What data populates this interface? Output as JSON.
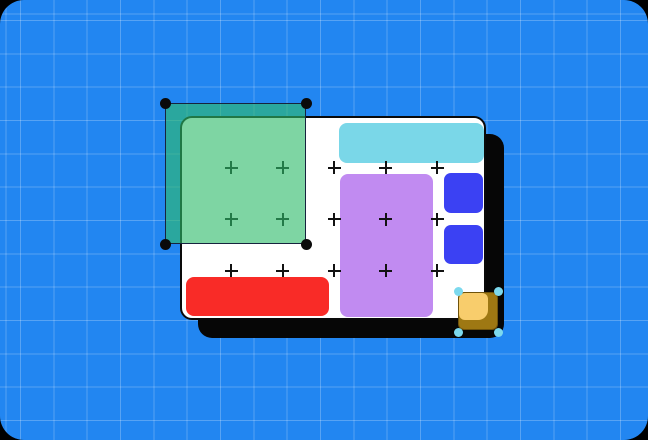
{
  "scene": {
    "width": 648,
    "height": 440,
    "outer_background": "#000000",
    "corner_radius": 24
  },
  "workspace": {
    "background": "#2286F1",
    "grid_line_color": "rgba(255,255,255,0.24)",
    "grid_size": 33.33,
    "grid_offset": 20
  },
  "artboard": {
    "x": 180,
    "y": 116,
    "w": 306,
    "h": 204,
    "background": "#FFFFFF",
    "border_color": "#0A0A0A",
    "border_w": 2,
    "radius": 12,
    "shadow": {
      "dx": 18,
      "dy": 18,
      "color": "#060606",
      "radius": 14
    }
  },
  "shapes": [
    {
      "name": "cyan-bar",
      "x": 339,
      "y": 123,
      "w": 145,
      "h": 40,
      "r": 8,
      "color": "#7AD7E8"
    },
    {
      "name": "purple-rect",
      "x": 340,
      "y": 174,
      "w": 93,
      "h": 143,
      "r": 8,
      "color": "#C18BF1"
    },
    {
      "name": "blue-square-1",
      "x": 444,
      "y": 173,
      "w": 39,
      "h": 40,
      "r": 7,
      "color": "#3B41F3"
    },
    {
      "name": "blue-square-2",
      "x": 444,
      "y": 225,
      "w": 39,
      "h": 39,
      "r": 7,
      "color": "#3B41F3"
    },
    {
      "name": "red-bar",
      "x": 186,
      "y": 277,
      "w": 143,
      "h": 39,
      "r": 8,
      "color": "#F92B27"
    }
  ],
  "cross_grid": {
    "cols": [
      231,
      282.5,
      334,
      385.5,
      437
    ],
    "rows": [
      167.5,
      219,
      270.5
    ],
    "size": 13,
    "stroke": 2,
    "color": "#121212"
  },
  "green_selection": {
    "x": 165,
    "y": 103,
    "w": 141,
    "h": 141,
    "fill": "rgba(47,187,106,0.62)",
    "border_color": "#16233E",
    "border_w": 1.5,
    "handle_color": "#0A0A0A",
    "handle_d": 11
  },
  "yellow_shape": {
    "x": 458,
    "y": 292,
    "w": 40,
    "h": 38,
    "r": 6,
    "shadow_color": "#9E7813",
    "shadow_outline": "rgba(40,28,0,0.4)",
    "face_color": "#F8CD6C",
    "face_dx": 1,
    "face_dy": 1,
    "face_w": 29,
    "face_h": 27,
    "face_radius": "6px 6px 10px 6px"
  },
  "yellow_selection": {
    "x": 458,
    "y": 291,
    "w": 40,
    "h": 41,
    "handle_color": "#7CD9EE",
    "handle_d": 9
  }
}
